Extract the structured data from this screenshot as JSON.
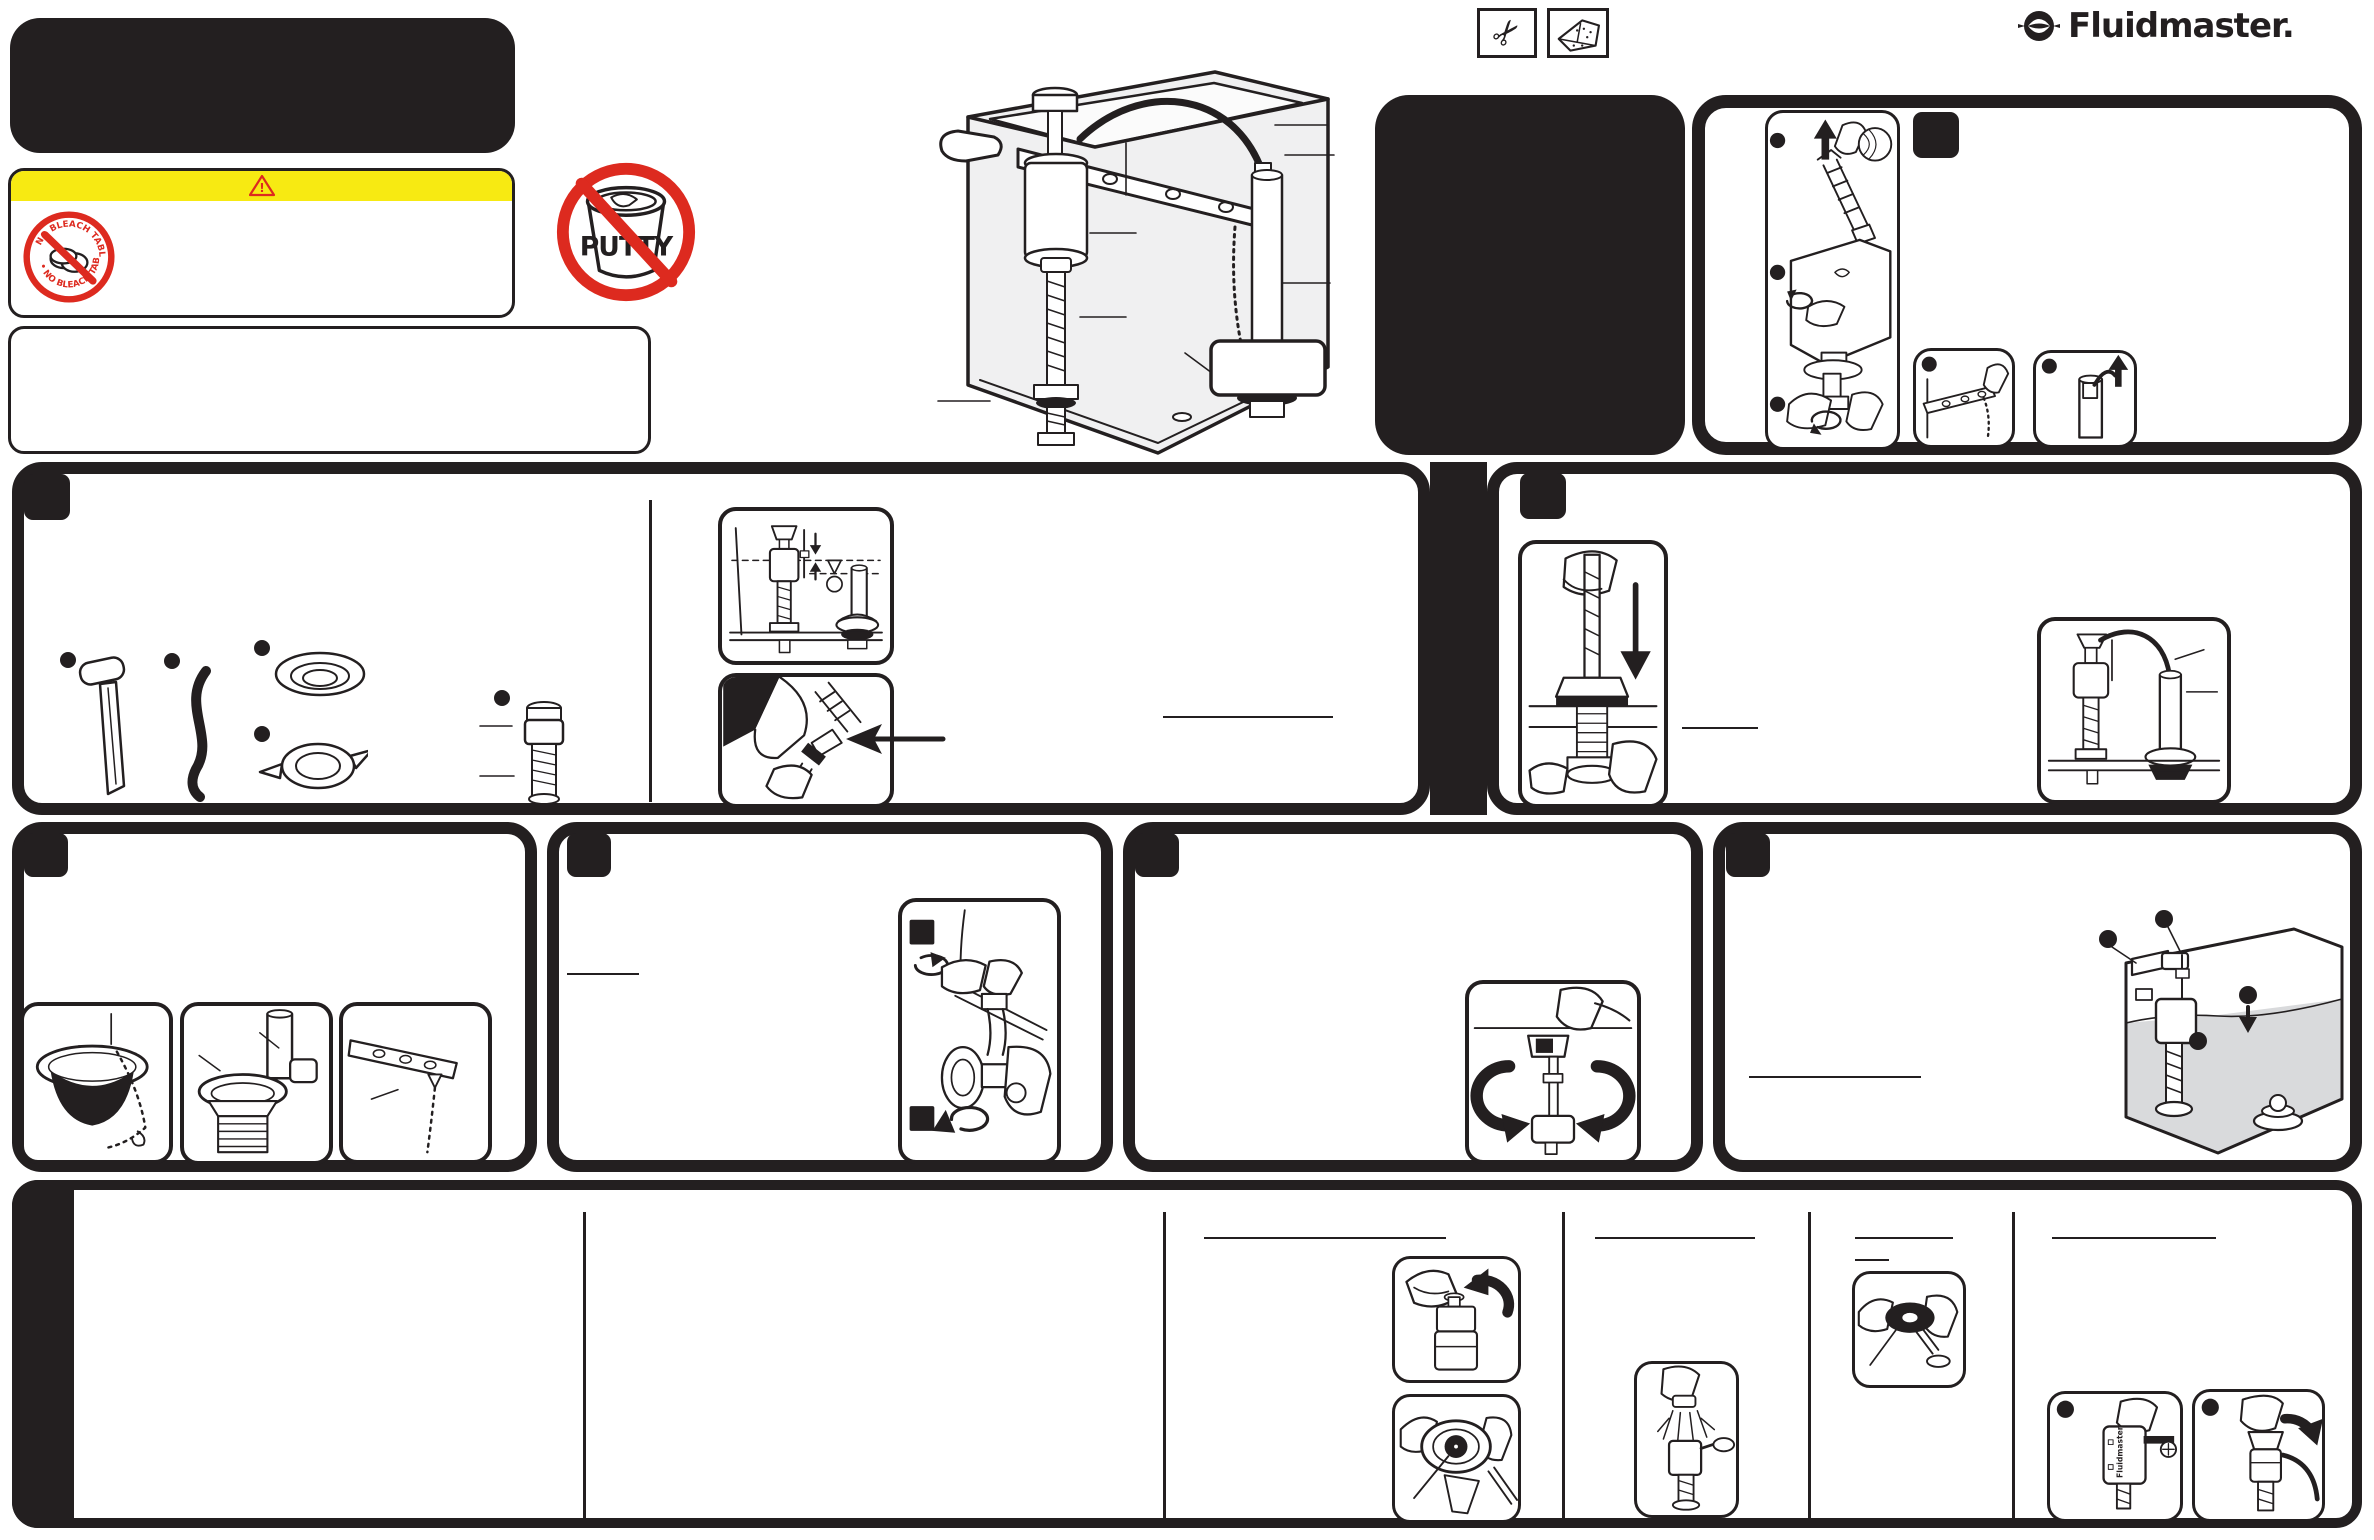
{
  "document": {
    "type": "instruction-sheet",
    "brand": "Fluidmaster",
    "note": "Toilet fill valve installation sheet; body text not legible in pixels (blank panels and underlines only)"
  },
  "logo": {
    "text": "Fluidmaster.",
    "icon": "fluidmaster-mark-icon"
  },
  "header_tools": {
    "icon_1": "scissors-icon",
    "icon_2": "sponge-icon"
  },
  "warning": {
    "symbol": "!"
  },
  "badges": {
    "no_bleach": {
      "arc_top": "NO BLEACH TABLETS",
      "arc_bottom": "• NO BLEACH TABLETS •"
    },
    "no_putty": {
      "label": "PUTTY"
    }
  },
  "illustrations": {
    "float_cup_label": "Fluidmaster"
  },
  "colors": {
    "ink": "#231f20",
    "warning_yellow": "#f7ea12",
    "alert_red": "#dd2a1f",
    "tank_water_gray": "#d9dadc"
  },
  "layout": {
    "top_left": [
      "title-block",
      "warning-box",
      "notes-box",
      "no-putty-badge"
    ],
    "top_center": [
      "tank-overview-diagram",
      "callout-box"
    ],
    "top_right": [
      "black-info-panel",
      "remove-old-valve-panel"
    ],
    "rows": [
      [
        "step-panel-parts",
        "step-panel-install-valve"
      ],
      [
        "step-panel-flapper",
        "step-panel-supply-line",
        "step-panel-adjust",
        "step-panel-water-level"
      ],
      [
        "troubleshooting-strip"
      ]
    ]
  }
}
